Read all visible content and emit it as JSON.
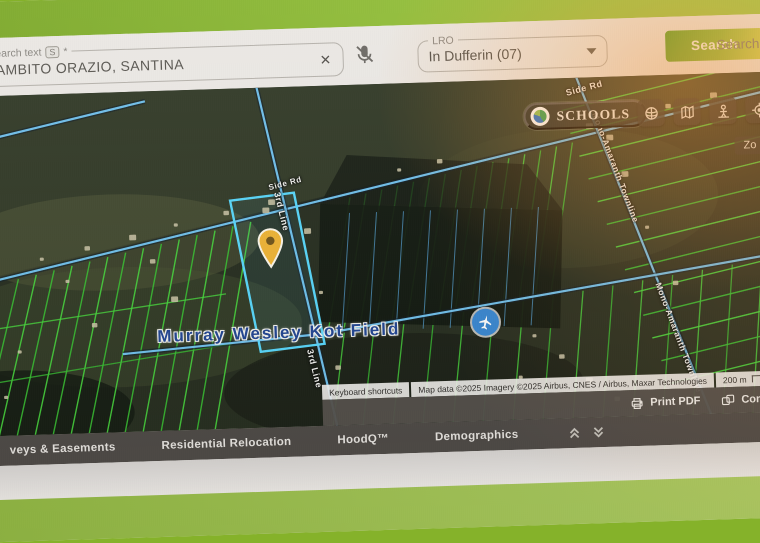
{
  "search_panel": {
    "search_field": {
      "label": "Search text",
      "shortcut": "S",
      "required": "*",
      "value": "ZAMBITO ORAZIO, SANTINA",
      "clear_glyph": "×"
    },
    "lro_field": {
      "label": "LRO",
      "value": "In Dufferin (07)"
    },
    "search_button_label": "Search",
    "secondary_search_label": "Search"
  },
  "map": {
    "schools_button_label": "SCHOOLS",
    "zoom_hint": "Zo",
    "field_label": "Murray Wesley Kot Field",
    "road_labels": {
      "side_rd": "Side Rd",
      "line_upper": "3rd Line",
      "line_lower": "3rd Line",
      "townline": "Mono-Amaranth Townline"
    },
    "attribution": {
      "keyboard_shortcuts": "Keyboard shortcuts",
      "map_data": "Map data ©2025 Imagery ©2025 Airbus, CNES / Airbus, Maxar Technologies",
      "scale": "200 m"
    }
  },
  "actions_bar": {
    "print_label": "Print PDF",
    "compare_label": "Comp"
  },
  "tabs": {
    "items": [
      "veys & Easements",
      "Residential Relocation",
      "HoodQ™",
      "Demographics"
    ]
  },
  "colors": {
    "accent_green": "#7fae22",
    "button_gradient_start": "#51a01c",
    "button_gradient_end": "#cfd44a",
    "parcel_green": "#3ed832",
    "road_blue": "#6ac0ef",
    "highlight_blue": "#4fd8ff",
    "pin_yellow": "#f2b32a"
  }
}
